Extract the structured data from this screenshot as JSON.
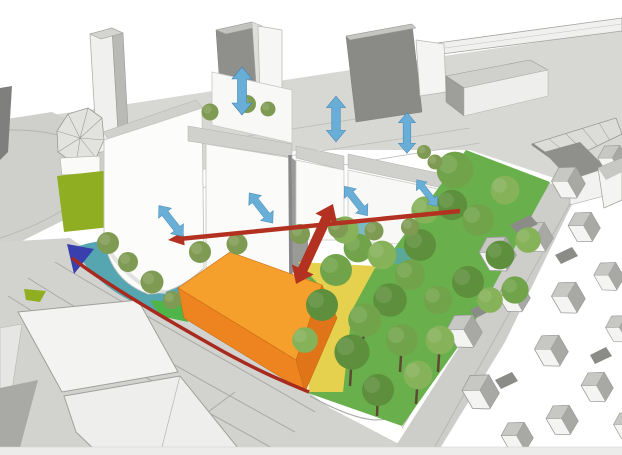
{
  "canvas": {
    "width": 622,
    "height": 455,
    "background": "#ffffff"
  },
  "palette": {
    "background": "#ffffff",
    "context_ground": "#d7d7d4",
    "street_grey": "#cdcdca",
    "building_white": "#fbfbfa",
    "building_grey_dark": "#8d8d8a",
    "roof_band_grey": "#d0d0cd",
    "massing_orange_top": "#f5a02d",
    "massing_orange_front": "#ee8420",
    "massing_orange_side": "#df7518",
    "lawn_olive": "#8fae21",
    "grass_green": "#4fb548",
    "grove_ground_green": "#69b04c",
    "zone_yellow": "#e6d14f",
    "plaza_teal": "#55a6b0",
    "water_blue": "#3a3fae",
    "arrow_red": "#b23120",
    "boundary_red": "#a82a1e",
    "arrow_blue": "#68aed6",
    "tree_olive": "#7f9b53",
    "tree_green_dark": "#5d8f3c",
    "tree_green_mid": "#71a44a",
    "tree_green_light": "#86b25a",
    "trunk_brown": "#5d4a32"
  },
  "diagram": {
    "blue_double_arrows": {
      "total": 7,
      "vertical": 3,
      "tilted": 4
    },
    "red_arrows": {
      "long_horizontal_left_pointing": 1,
      "diagonal_double_headed": 1
    },
    "red_boundary_lines": 1,
    "colored_zones": [
      "orange-massing-volume",
      "yellow-zone",
      "teal-plaza",
      "blue-water-triangle",
      "olive-lawn",
      "green-lawn-strip",
      "tree-grove"
    ]
  }
}
